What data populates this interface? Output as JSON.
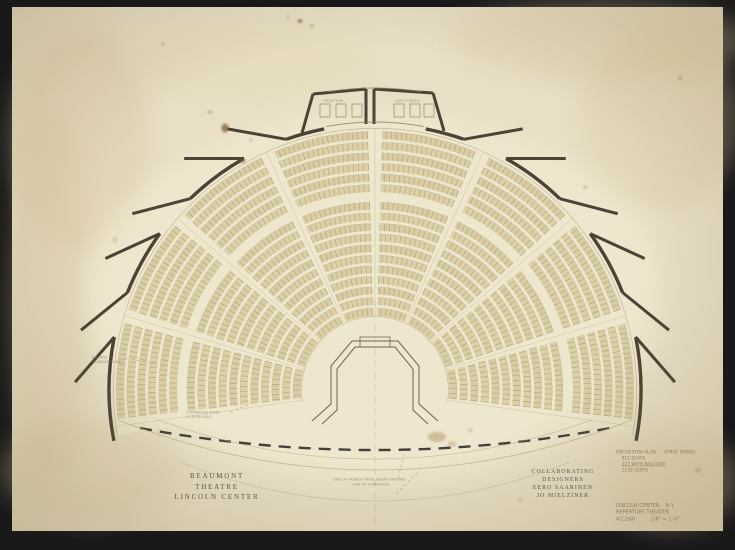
{
  "drawing": {
    "printed_title": {
      "lines": [
        "BEAUMONT",
        "THEATRE",
        "LINCOLN CENTER"
      ]
    },
    "printed_credits": {
      "lines": [
        "COLLABORATING",
        "DESIGNERS",
        "EERO SAARINEN",
        "JO MIELZINER"
      ]
    },
    "plan_notes": {
      "heading": "ORCHESTRA PLAN      (FIRST DRWG)",
      "seats_orchestra": "911 SEATS",
      "seats_balcony": "227 WITH BALCONY",
      "seats_total": "1138 SEATS"
    },
    "title_notes": {
      "line1": "LINCOLN CENTER    N.Y.",
      "line2": "REPERTORY THEATER",
      "line3": "4/12/60          1/8\" = 1'-0\""
    },
    "stage_notes": {
      "line1": "LINE OF MOBILE PROSCENIUM OPENING",
      "line2": "LINE OF FORESTAGE"
    },
    "left_note": {
      "line1": "EXISTING",
      "line2": "FOUNDATION WALL"
    },
    "aisle_note": {
      "line1": "CONTINUOUS ROWS",
      "line2": "& CROSS AISLE"
    },
    "booths": {
      "left": "PROJECTION",
      "right": "LIGHT CONTROL"
    },
    "colors": {
      "background": "#191919",
      "paper": "#e8dfc6",
      "wall_ink": "#4a4336",
      "stage_ink": "#6d6350",
      "seat_fill": "#d7cb9e",
      "seat_tick": "#837650",
      "row_edge": "#9c8f66",
      "pencil": "#8b7d5f",
      "faint_line": "#b3a67e"
    }
  }
}
